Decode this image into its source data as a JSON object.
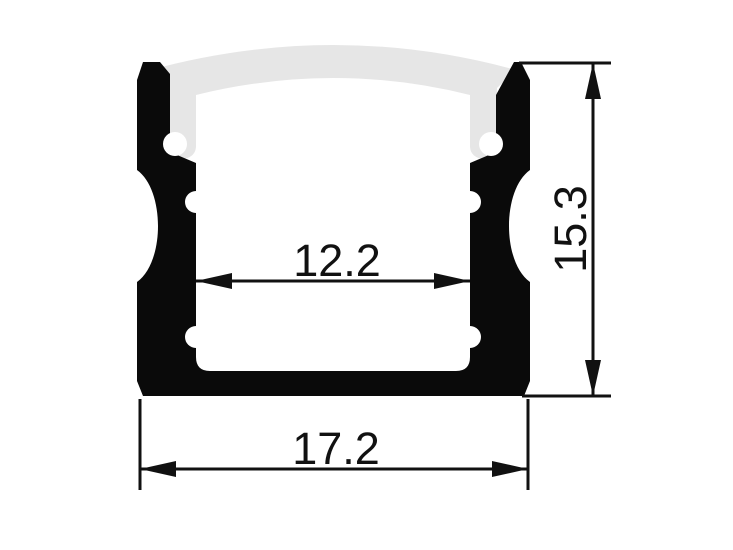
{
  "dimensions": {
    "inner_width": "12.2",
    "outer_width": "17.2",
    "height": "15.3"
  },
  "colors": {
    "background": "#ffffff",
    "profile": "#0a0a0a",
    "diffuser": "#e6e6e6",
    "line": "#111111"
  }
}
